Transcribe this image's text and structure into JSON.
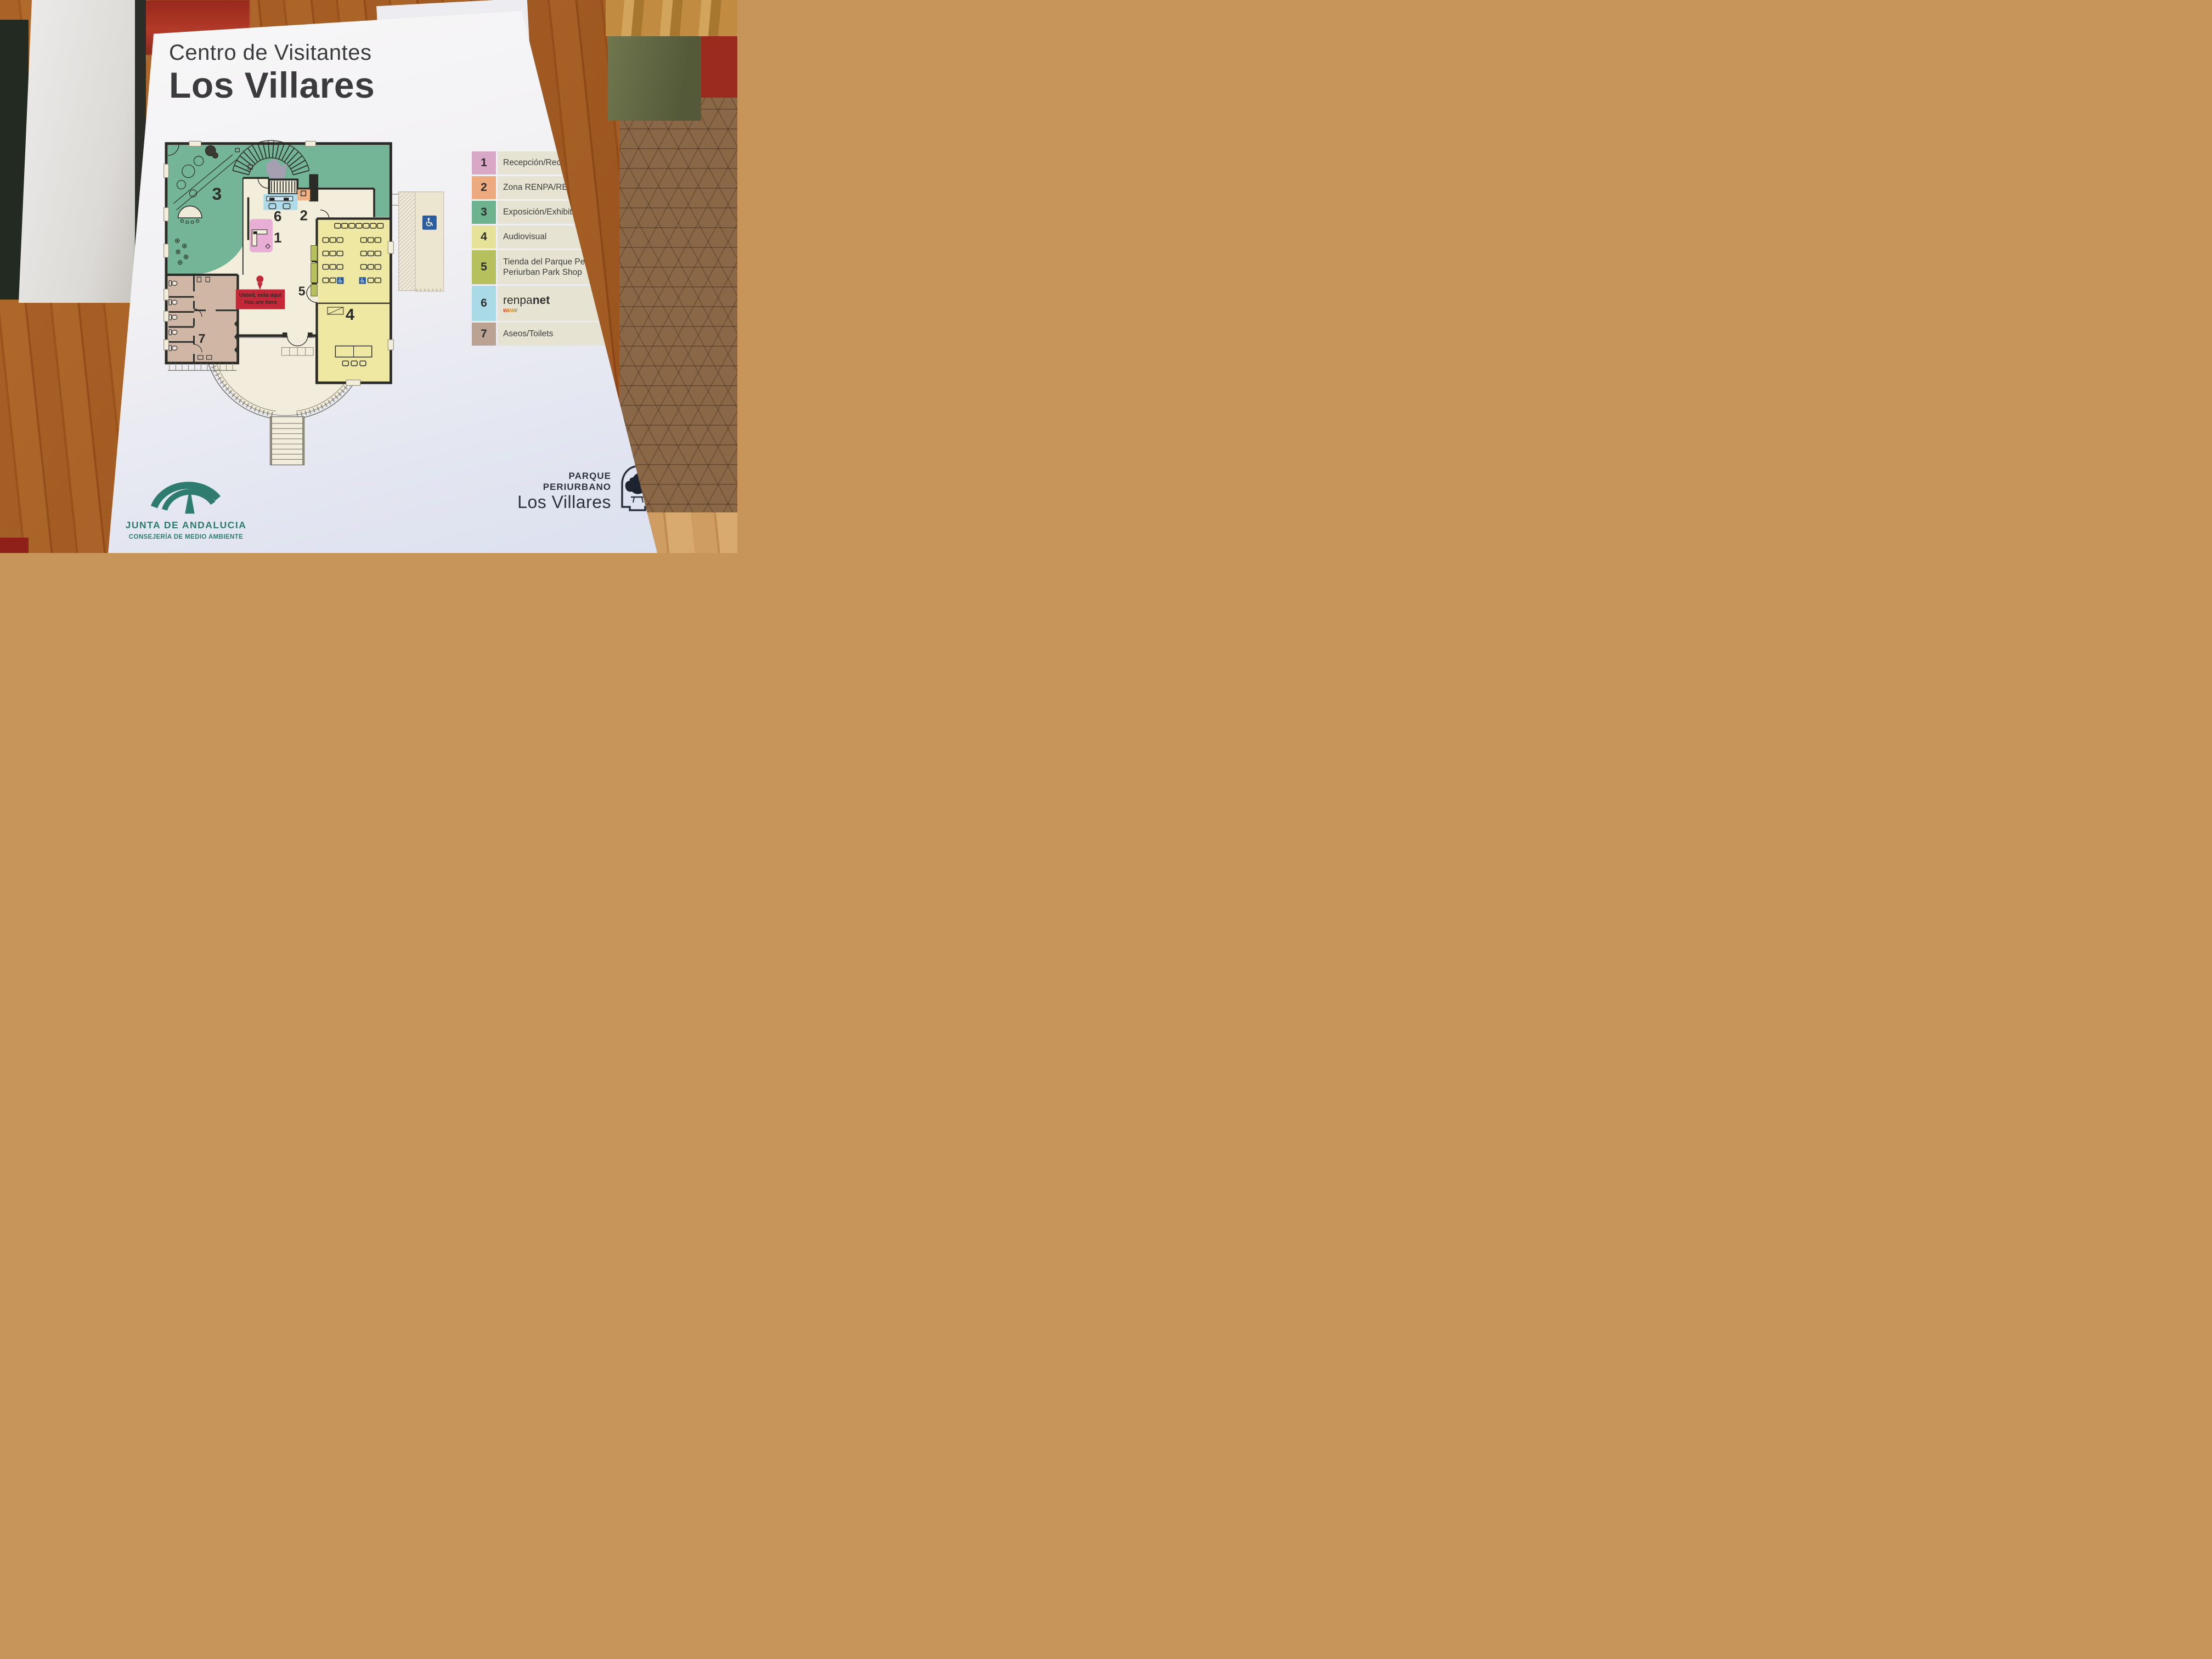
{
  "sign": {
    "title": {
      "line1": "Centro de Visitantes",
      "line2": "Los Villares"
    },
    "plan": {
      "room_numbers": {
        "r1": "1",
        "r2": "2",
        "r3": "3",
        "r4": "4",
        "r5": "5",
        "r6": "6",
        "r7": "7"
      },
      "you_are_here": {
        "line1": "Usted, esta aquí",
        "line2": "You are here"
      },
      "accessible_icon": "wheelchair-icon",
      "accent_colors": {
        "reception_pink": "#e9aed6",
        "renpa_orange": "#f0b183",
        "exhibition_green": "#74b497",
        "audiovisual_yellow": "#efe8a3",
        "shop_olive": "#b6c15d",
        "renpanet_blue": "#aedbe9",
        "toilets_tan": "#cfb6a5",
        "wall_black": "#2b2b28",
        "floor_cream": "#f3eedb",
        "marker_red": "#c22837",
        "handicap_blue": "#2a5d9f"
      }
    },
    "legend": {
      "items": [
        {
          "num": "1",
          "label": "Recepción/Reception",
          "color": "#d9a8c6"
        },
        {
          "num": "2",
          "label": "Zona RENPA/RENPA Area",
          "color": "#edaa7e"
        },
        {
          "num": "3",
          "label": "Exposición/Exhibition",
          "color": "#6db390"
        },
        {
          "num": "4",
          "label": "Audiovisual",
          "color": "#e6e29a"
        },
        {
          "num": "5",
          "label": "Tienda del Parque Periurbano/ Periurban Park Shop",
          "color": "#b6c15d"
        },
        {
          "num": "6",
          "label_a": "renpa",
          "label_b": "net",
          "label_sub": "www",
          "color": "#a9dbe6"
        },
        {
          "num": "7",
          "label": "Aseos/Toilets",
          "color": "#bca293"
        }
      ]
    },
    "footer_left": {
      "org": "JUNTA DE ANDALUCIA",
      "dept": "CONSEJERÍA DE MEDIO AMBIENTE"
    },
    "footer_right": {
      "line1": "PARQUE PERIURBANO",
      "line2": "Los Villares"
    }
  }
}
